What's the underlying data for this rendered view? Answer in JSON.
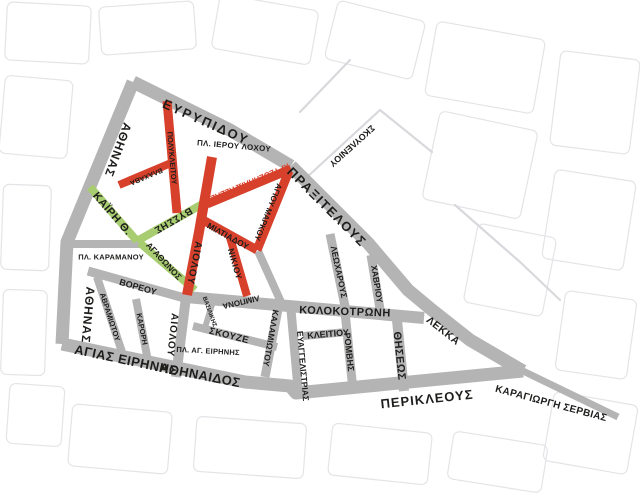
{
  "map": {
    "title": "Athens commercial triangle street map",
    "width": 640,
    "height": 494,
    "colors": {
      "gray": "#b4b4b5",
      "red": "#d7402b",
      "green": "#a8cc70",
      "black": "#1d1d1b",
      "faint": "#e4e4e8",
      "thin": "#d9d9dd",
      "background": "#ffffff"
    },
    "streets": [
      {
        "id": "athinas",
        "name": "ΑΘΗΝΑΣ",
        "color": "gray",
        "width": 13,
        "points": [
          [
            133,
            82
          ],
          [
            67,
            242
          ],
          [
            62,
            344
          ]
        ]
      },
      {
        "id": "evripidou",
        "name": "ΕΥΡΥΠΙΔΟΥ",
        "color": "gray",
        "width": 13,
        "points": [
          [
            133,
            82
          ],
          [
            230,
            130
          ],
          [
            291,
            166
          ]
        ]
      },
      {
        "id": "praxitelous-lekka",
        "name": "ΠΡΑΞΙΤΕΛΟΥΣ / ΛΕΚΚΑ",
        "color": "gray",
        "width": 13,
        "points": [
          [
            291,
            166
          ],
          [
            368,
            243
          ],
          [
            408,
            290
          ],
          [
            432,
            310
          ],
          [
            470,
            340
          ],
          [
            523,
            371
          ]
        ]
      },
      {
        "id": "agias-eirinis-athinaidos-perikleous",
        "name": "ΑΓΙΑΣ ΕΙΡΗΝΗΣ / ΑΘΗΝΑΙΔΟΣ / ΠΕΡΙΚΛΕΟΥΣ",
        "color": "gray",
        "width": 13,
        "points": [
          [
            62,
            344
          ],
          [
            245,
            382
          ],
          [
            290,
            386
          ],
          [
            296,
            393
          ],
          [
            523,
            371
          ]
        ]
      },
      {
        "id": "kolokotroni",
        "name": "ΚΟΛΟΚΟΤΡΩΝΗ",
        "color": "gray",
        "width": 12,
        "points": [
          [
            186,
            297
          ],
          [
            300,
            307
          ],
          [
            424,
            318
          ]
        ]
      },
      {
        "id": "aiolou-south",
        "name": "ΑΙΟΛΟΥ",
        "color": "gray",
        "width": 10,
        "points": [
          [
            186,
            297
          ],
          [
            176,
            377
          ]
        ]
      },
      {
        "id": "voreou",
        "name": "ΒΟΡΕΟΥ",
        "color": "gray",
        "width": 9,
        "points": [
          [
            88,
            271
          ],
          [
            188,
            299
          ]
        ]
      },
      {
        "id": "avramiotou",
        "name": "ΑΒΡΑΜΙΩΤΟΥ",
        "color": "gray",
        "width": 8,
        "points": [
          [
            97,
            277
          ],
          [
            124,
            358
          ]
        ]
      },
      {
        "id": "karori",
        "name": "ΚΑΡΟΡΗ",
        "color": "gray",
        "width": 8,
        "points": [
          [
            136,
            299
          ],
          [
            148,
            361
          ]
        ]
      },
      {
        "id": "pl-karamanou-street",
        "name": "ΠΛ. ΚΑΡΑΜΑΝΟΥ",
        "color": "gray",
        "width": 8,
        "points": [
          [
            67,
            244
          ],
          [
            140,
            244
          ]
        ]
      },
      {
        "id": "skouze",
        "name": "ΣΚΟΥΖΕ",
        "color": "gray",
        "width": 8,
        "points": [
          [
            193,
            326
          ],
          [
            277,
            347
          ]
        ]
      },
      {
        "id": "vasilikis",
        "name": "ΒΑΣΙΛΙΚΗΣ",
        "color": "gray",
        "width": 6,
        "points": [
          [
            214,
            298
          ],
          [
            204,
            331
          ]
        ]
      },
      {
        "id": "kalamiotou",
        "name": "ΚΑΛΑΜΙΩΤΟΥ",
        "color": "gray",
        "width": 9,
        "points": [
          [
            279,
            304
          ],
          [
            265,
            377
          ]
        ]
      },
      {
        "id": "kalamiotou-north",
        "name": "ΚΑΛΑΜΙΩΤΟΥ (ΒΟΡΕΙΟ ΤΜΗΜΑ)",
        "color": "gray",
        "width": 8,
        "points": [
          [
            258,
            251
          ],
          [
            281,
            302
          ]
        ]
      },
      {
        "id": "evangelistrias",
        "name": "ΕΥΑΓΓΕΛΙΣΤΡΙΑΣ",
        "color": "gray",
        "width": 9,
        "points": [
          [
            291,
            310
          ],
          [
            298,
            388
          ]
        ]
      },
      {
        "id": "kleitiou",
        "name": "ΚΛΕΙΤΙΟΥ",
        "color": "gray",
        "width": 8,
        "points": [
          [
            303,
            336
          ],
          [
            347,
            332
          ]
        ]
      },
      {
        "id": "romvis",
        "name": "ΡΟΜΒΗΣ",
        "color": "gray",
        "width": 9,
        "points": [
          [
            345,
            312
          ],
          [
            353,
            390
          ]
        ]
      },
      {
        "id": "leocharous",
        "name": "ΛΕΩΧΑΡΟΥΣ",
        "color": "gray",
        "width": 9,
        "points": [
          [
            330,
            234
          ],
          [
            346,
            311
          ]
        ]
      },
      {
        "id": "havriou",
        "name": "ΧΑΒΡΙΟΥ",
        "color": "gray",
        "width": 9,
        "points": [
          [
            371,
            255
          ],
          [
            381,
            315
          ]
        ]
      },
      {
        "id": "theseos",
        "name": "ΘΗΣΕΩΣ",
        "color": "gray",
        "width": 10,
        "points": [
          [
            397,
            320
          ],
          [
            404,
            391
          ]
        ]
      },
      {
        "id": "karagiorgi-servias",
        "name": "ΚΑΡΑΓΙΩΡΓΗ ΣΕΡΒΙΑΣ",
        "color": "gray",
        "width": 7,
        "points": [
          [
            523,
            371
          ],
          [
            618,
            417
          ]
        ]
      },
      {
        "id": "kairi",
        "name": "ΚΑΪΡΗ Θ.",
        "color": "green",
        "width": 8,
        "points": [
          [
            90,
            187
          ],
          [
            137,
            241
          ]
        ]
      },
      {
        "id": "vyssis",
        "name": "ΒΥΣΣΗΣ",
        "color": "green",
        "width": 8,
        "points": [
          [
            137,
            241
          ],
          [
            206,
            202
          ]
        ]
      },
      {
        "id": "agathonos",
        "name": "ΑΓΑΘΩΝΟΣ",
        "color": "green",
        "width": 8,
        "points": [
          [
            140,
            243
          ],
          [
            195,
            290
          ]
        ]
      },
      {
        "id": "polykleitou",
        "name": "ΠΟΛΥΚΛΕΙΤΟΥ",
        "color": "red",
        "width": 9,
        "points": [
          [
            167,
            101
          ],
          [
            177,
            213
          ]
        ]
      },
      {
        "id": "vlachava",
        "name": "ΒΛΑΧΑΒΑ",
        "color": "red",
        "width": 8,
        "points": [
          [
            119,
            185
          ],
          [
            171,
            163
          ]
        ]
      },
      {
        "id": "aiolou-north",
        "name": "ΑΙΟΛΟΥ",
        "color": "red",
        "width": 10,
        "points": [
          [
            212,
            157
          ],
          [
            199,
            232
          ],
          [
            187,
            295
          ]
        ]
      },
      {
        "id": "chrysospiliotissis",
        "name": "ΧΡΥΣΟΣΠΗΛΙΩΤΙΣΣΗΣ",
        "color": "red",
        "width": 9,
        "points": [
          [
            207,
            204
          ],
          [
            291,
            169
          ]
        ]
      },
      {
        "id": "agiou-markou",
        "name": "ΑΓΙΟΥ ΜΑΡΚΟΥ",
        "color": "red",
        "width": 9,
        "points": [
          [
            289,
            171
          ],
          [
            257,
            250
          ]
        ]
      },
      {
        "id": "miltiadou",
        "name": "ΜΙΛΤΙΑΔΟΥ",
        "color": "red",
        "width": 9,
        "points": [
          [
            203,
            220
          ],
          [
            257,
            250
          ]
        ]
      },
      {
        "id": "nikiou",
        "name": "ΝΙΚΙΟΥ",
        "color": "red",
        "width": 8,
        "points": [
          [
            229,
            234
          ],
          [
            247,
            296
          ]
        ]
      }
    ],
    "labels": [
      {
        "id": "evripidou",
        "text": "ΕΥΡΥΠΙΔΟΥ",
        "x": 206,
        "y": 122,
        "rot": 24,
        "size": 13,
        "ls": 2,
        "color": "black"
      },
      {
        "id": "pl-ierou-lochou",
        "text": "ΠΛ. ΙΕΡΟΥ ΛΟΧΟΥ",
        "x": 234,
        "y": 146,
        "rot": 5,
        "size": 8,
        "ls": 0.3,
        "color": "black"
      },
      {
        "id": "athinas-upper",
        "text": "ΑΘΗΝΑΣ",
        "x": 118,
        "y": 150,
        "rot": 110,
        "size": 12,
        "ls": 1,
        "color": "black"
      },
      {
        "id": "polykleitou",
        "text": "ΠΟΛΥΚΛΕΙΤΟΥ",
        "x": 172,
        "y": 158,
        "rot": 85,
        "size": 7.5,
        "ls": 0,
        "color": "black"
      },
      {
        "id": "vlachava",
        "text": "ΒΛΑΧΑΒΑ",
        "x": 146,
        "y": 176,
        "rot": 157,
        "size": 7,
        "ls": 0,
        "color": "black"
      },
      {
        "id": "kairi",
        "text": "ΚΑΪΡΗ Θ.",
        "x": 112,
        "y": 214,
        "rot": 49,
        "size": 11,
        "ls": 0.5,
        "color": "black"
      },
      {
        "id": "vyssis",
        "text": "ΒΥΣΣΗΣ",
        "x": 173,
        "y": 220,
        "rot": 150,
        "size": 10,
        "ls": 0.5,
        "color": "black"
      },
      {
        "id": "pl-karamanou",
        "text": "ΠΛ. ΚΑΡΑΜΑΝΟΥ",
        "x": 111,
        "y": 257,
        "rot": 0,
        "size": 7.5,
        "ls": 0.2,
        "color": "black"
      },
      {
        "id": "agathonos",
        "text": "ΑΓΑΘΩΝΟΣ",
        "x": 164,
        "y": 261,
        "rot": 47,
        "size": 8.5,
        "ls": 0,
        "color": "black"
      },
      {
        "id": "chrysospiliotissis",
        "text": "ΧΡΥΣΟΣΠΗΛΙΩΤΙΣΣΗΣ",
        "x": 250,
        "y": 182,
        "rot": 157,
        "size": 8,
        "ls": 0,
        "color": "red"
      },
      {
        "id": "agiou-markou",
        "text": "ΑΓΙΟΥ ΜΑΡΚΟΥ",
        "x": 268,
        "y": 212,
        "rot": 112,
        "size": 8,
        "ls": 0,
        "color": "black"
      },
      {
        "id": "miltiadou",
        "text": "ΜΙΛΤΙΑΔΟΥ",
        "x": 228,
        "y": 236,
        "rot": 29,
        "size": 8.5,
        "ls": 0,
        "color": "black"
      },
      {
        "id": "aiolou-red",
        "text": "ΑΙΟΛΟΥ",
        "x": 194,
        "y": 263,
        "rot": 101,
        "size": 10,
        "ls": 1,
        "color": "black"
      },
      {
        "id": "nikiou",
        "text": "ΝΙΚΙΟΥ",
        "x": 235,
        "y": 264,
        "rot": 74,
        "size": 8.5,
        "ls": 0.5,
        "color": "black"
      },
      {
        "id": "skouleniou",
        "text": "ΣΚΟΥΛΕΝΙΟΥ",
        "x": 352,
        "y": 146,
        "rot": 138,
        "size": 9,
        "ls": 0,
        "color": "black"
      },
      {
        "id": "praxitelous",
        "text": "ΠΡΑΞΙΤΕΛΟΥΣ",
        "x": 327,
        "y": 207,
        "rot": 45,
        "size": 13,
        "ls": 1.5,
        "color": "black"
      },
      {
        "id": "leocharous",
        "text": "ΛΕΩΧΑΡΟΥΣ",
        "x": 339,
        "y": 272,
        "rot": 78,
        "size": 8.5,
        "ls": 0,
        "color": "black"
      },
      {
        "id": "havriou",
        "text": "ΧΑΒΡΙΟΥ",
        "x": 377,
        "y": 284,
        "rot": 81,
        "size": 8.5,
        "ls": 0,
        "color": "black"
      },
      {
        "id": "kolokotroni",
        "text": "ΚΟΛΟΚΟΤΡΩΝΗ",
        "x": 345,
        "y": 312,
        "rot": 2,
        "size": 11,
        "ls": 0.5,
        "color": "black"
      },
      {
        "id": "limpona",
        "text": "ΛΙΜΠΟΝΑ",
        "x": 241,
        "y": 302,
        "rot": 167,
        "size": 8,
        "ls": 0,
        "color": "black"
      },
      {
        "id": "vasilikis",
        "text": "ΒΑΣΙΛΙΚΗΣ",
        "x": 209,
        "y": 312,
        "rot": 70,
        "size": 6,
        "ls": 0,
        "color": "black"
      },
      {
        "id": "voreou",
        "text": "ΒΟΡΕΟΥ",
        "x": 138,
        "y": 287,
        "rot": 16,
        "size": 9,
        "ls": 0,
        "color": "black"
      },
      {
        "id": "athinas-lower",
        "text": "ΑΘΗΝΑΣ",
        "x": 88,
        "y": 315,
        "rot": 95,
        "size": 12,
        "ls": 1,
        "color": "black"
      },
      {
        "id": "avramiotou",
        "text": "ΑΒΡΑΜΙΩΤΟΥ",
        "x": 110,
        "y": 317,
        "rot": 72,
        "size": 7.5,
        "ls": 0,
        "color": "black"
      },
      {
        "id": "karori",
        "text": "ΚΑΡΟΡΗ",
        "x": 142,
        "y": 329,
        "rot": 79,
        "size": 7.5,
        "ls": 0,
        "color": "black"
      },
      {
        "id": "aiolou-gray",
        "text": "ΑΙΟΛΟΥ",
        "x": 172,
        "y": 335,
        "rot": 96,
        "size": 10,
        "ls": 1,
        "color": "black"
      },
      {
        "id": "skouze",
        "text": "ΣΚΟΥΖΕ",
        "x": 229,
        "y": 336,
        "rot": 14,
        "size": 9.5,
        "ls": 0.5,
        "color": "black"
      },
      {
        "id": "pl-ag-eirinis",
        "text": "ΠΛ. ΑΓ. ΕΙΡΗΝΗΣ",
        "x": 208,
        "y": 351,
        "rot": 3,
        "size": 7.5,
        "ls": 0.2,
        "color": "black"
      },
      {
        "id": "kalamiotou",
        "text": "ΚΑΛΑΜΙΩΤΟΥ",
        "x": 271,
        "y": 338,
        "rot": 100,
        "size": 8.5,
        "ls": 0,
        "color": "black"
      },
      {
        "id": "evangelistrias",
        "text": "ΕΥΑΓΓΕΛΙΣΤΡΙΑΣ",
        "x": 303,
        "y": 366,
        "rot": 85,
        "size": 8.5,
        "ls": 0,
        "color": "black"
      },
      {
        "id": "kleitiou",
        "text": "ΚΛΕΙΤΙΟΥ",
        "x": 328,
        "y": 334,
        "rot": -5,
        "size": 9,
        "ls": 0,
        "color": "black"
      },
      {
        "id": "romvis",
        "text": "ΡΟΜΒΗΣ",
        "x": 349,
        "y": 352,
        "rot": 84,
        "size": 9,
        "ls": 0,
        "color": "black"
      },
      {
        "id": "theseos",
        "text": "ΘΗΣΕΩΣ",
        "x": 399,
        "y": 356,
        "rot": 84,
        "size": 11,
        "ls": 0.5,
        "color": "black"
      },
      {
        "id": "lekka",
        "text": "ΛΕΚΚΑ",
        "x": 443,
        "y": 331,
        "rot": 38,
        "size": 10.5,
        "ls": 0.5,
        "color": "black"
      },
      {
        "id": "agias-eirinis",
        "text": "ΑΓΙΑΣ ΕΙΡΗΝΗΣ",
        "x": 126,
        "y": 360,
        "rot": 12,
        "size": 13,
        "ls": 0.5,
        "color": "black"
      },
      {
        "id": "athinaidos",
        "text": "ΑΘΗΝΑΙΔΟΣ",
        "x": 200,
        "y": 375,
        "rot": 11,
        "size": 13,
        "ls": 0.5,
        "color": "black"
      },
      {
        "id": "perikleous",
        "text": "ΠΕΡΙΚΛΕΟΥΣ",
        "x": 427,
        "y": 399,
        "rot": -6,
        "size": 13,
        "ls": 1,
        "color": "black"
      },
      {
        "id": "karagiorgi-servias",
        "text": "ΚΑΡΑΓΙΩΡΓΗ ΣΕΡΒΙΑΣ",
        "x": 551,
        "y": 404,
        "rot": 15,
        "size": 10,
        "ls": 0.3,
        "color": "black"
      }
    ],
    "thin_streets": [
      {
        "id": "skouleniou-street",
        "points": [
          [
            306,
            178
          ],
          [
            380,
            110
          ]
        ]
      },
      {
        "id": "bg-line-1",
        "points": [
          [
            380,
            110
          ],
          [
            432,
            152
          ]
        ]
      },
      {
        "id": "bg-line-2",
        "points": [
          [
            350,
            60
          ],
          [
            300,
            112
          ]
        ]
      },
      {
        "id": "bg-line-3",
        "points": [
          [
            455,
            205
          ],
          [
            520,
            262
          ],
          [
            560,
            300
          ]
        ]
      }
    ],
    "background_blocks": [
      {
        "x": 6,
        "y": 4,
        "w": 84,
        "h": 58,
        "r": 3
      },
      {
        "x": 2,
        "y": 78,
        "w": 68,
        "h": 78,
        "r": 5
      },
      {
        "x": 100,
        "y": 4,
        "w": 95,
        "h": 48,
        "r": -4
      },
      {
        "x": 215,
        "y": 2,
        "w": 100,
        "h": 55,
        "r": 10
      },
      {
        "x": 330,
        "y": 10,
        "w": 90,
        "h": 60,
        "r": 14
      },
      {
        "x": 430,
        "y": 30,
        "w": 110,
        "h": 75,
        "r": 10
      },
      {
        "x": 555,
        "y": 55,
        "w": 80,
        "h": 95,
        "r": 7
      },
      {
        "x": 430,
        "y": 120,
        "w": 100,
        "h": 90,
        "r": 12
      },
      {
        "x": 548,
        "y": 175,
        "w": 82,
        "h": 90,
        "r": 9
      },
      {
        "x": 470,
        "y": 230,
        "w": 80,
        "h": 80,
        "r": 11
      },
      {
        "x": 560,
        "y": 295,
        "w": 72,
        "h": 80,
        "r": 8
      },
      {
        "x": 548,
        "y": 398,
        "w": 85,
        "h": 70,
        "r": 10
      },
      {
        "x": 70,
        "y": 408,
        "w": 100,
        "h": 62,
        "r": 5
      },
      {
        "x": 195,
        "y": 420,
        "w": 110,
        "h": 55,
        "r": 4
      },
      {
        "x": 330,
        "y": 428,
        "w": 100,
        "h": 52,
        "r": 6
      },
      {
        "x": 450,
        "y": 438,
        "w": 95,
        "h": 48,
        "r": 9
      },
      {
        "x": 2,
        "y": 185,
        "w": 48,
        "h": 85,
        "r": 2
      },
      {
        "x": 2,
        "y": 290,
        "w": 44,
        "h": 85,
        "r": 2
      },
      {
        "x": 8,
        "y": 385,
        "w": 55,
        "h": 60,
        "r": 4
      }
    ]
  }
}
